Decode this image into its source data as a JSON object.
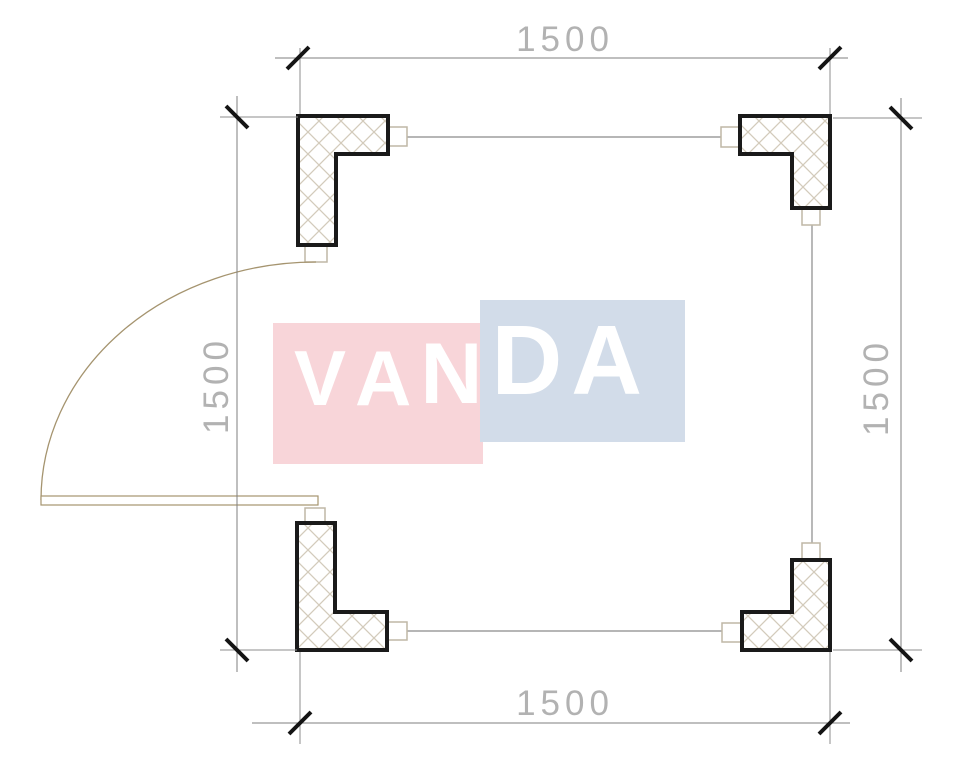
{
  "watermark": {
    "text": "VANDA",
    "letters": [
      "V",
      "A",
      "N",
      "D",
      "A"
    ],
    "colors": {
      "pink": "#f8d5d9",
      "blue": "#d2dce9",
      "text": "#ffffff"
    }
  },
  "dimensions": {
    "top": "1500",
    "bottom": "1500",
    "left": "1500",
    "right": "1500"
  },
  "plan": {
    "type": "floor-plan",
    "corner_columns": [
      "top-left",
      "top-right",
      "bottom-left",
      "bottom-right"
    ],
    "door": {
      "side": "left",
      "swing": "quarter-arc"
    },
    "colors": {
      "column_outline": "#1a1a1a",
      "hatch": "#d3cbbb",
      "dimension_line": "#7f7f7f",
      "extension_line": "#8d8d8d",
      "wall_line": "#8a8a8a",
      "tick": "#141414",
      "dimension_text": "#b2b2b2",
      "door": "#a5946f"
    }
  }
}
